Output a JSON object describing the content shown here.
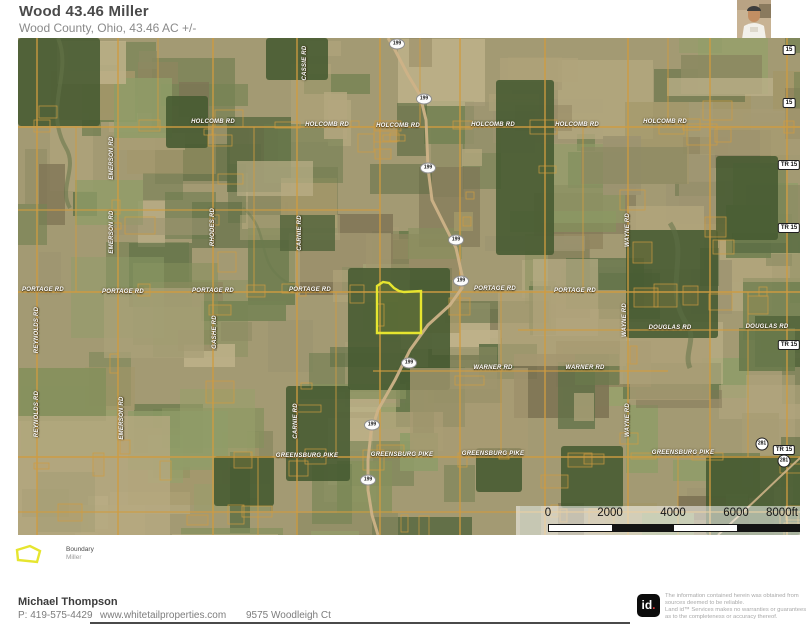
{
  "header": {
    "title": "Wood 43.46 Miller",
    "subtitle": "Wood County, Ohio, 43.46 AC +/-"
  },
  "map": {
    "road_labels": [
      {
        "text": "HOLCOMB RD",
        "x": 195,
        "y": 84,
        "vertical": false
      },
      {
        "text": "HOLCOMB RD",
        "x": 309,
        "y": 87,
        "vertical": false
      },
      {
        "text": "HOLCOMB RD",
        "x": 380,
        "y": 88,
        "vertical": false
      },
      {
        "text": "HOLCOMB RD",
        "x": 475,
        "y": 87,
        "vertical": false
      },
      {
        "text": "HOLCOMB RD",
        "x": 559,
        "y": 87,
        "vertical": false
      },
      {
        "text": "HOLCOMB RD",
        "x": 647,
        "y": 84,
        "vertical": false
      },
      {
        "text": "PORTAGE RD",
        "x": 25,
        "y": 252,
        "vertical": false
      },
      {
        "text": "PORTAGE RD",
        "x": 105,
        "y": 254,
        "vertical": false
      },
      {
        "text": "PORTAGE RD",
        "x": 195,
        "y": 253,
        "vertical": false
      },
      {
        "text": "PORTAGE RD",
        "x": 292,
        "y": 252,
        "vertical": false
      },
      {
        "text": "PORTAGE RD",
        "x": 477,
        "y": 251,
        "vertical": false
      },
      {
        "text": "PORTAGE RD",
        "x": 557,
        "y": 253,
        "vertical": false
      },
      {
        "text": "DOUGLAS RD",
        "x": 652,
        "y": 290,
        "vertical": false
      },
      {
        "text": "DOUGLAS RD",
        "x": 749,
        "y": 289,
        "vertical": false
      },
      {
        "text": "WARNER RD",
        "x": 475,
        "y": 330,
        "vertical": false
      },
      {
        "text": "WARNER RD",
        "x": 567,
        "y": 330,
        "vertical": false
      },
      {
        "text": "GREENSBURG PIKE",
        "x": 289,
        "y": 418,
        "vertical": false
      },
      {
        "text": "GREENSBURG PIKE",
        "x": 384,
        "y": 417,
        "vertical": false
      },
      {
        "text": "GREENSBURG PIKE",
        "x": 475,
        "y": 416,
        "vertical": false
      },
      {
        "text": "GREENSBURG PIKE",
        "x": 665,
        "y": 415,
        "vertical": false
      },
      {
        "text": "REYNOLDS RD",
        "x": 19,
        "y": 292,
        "vertical": true
      },
      {
        "text": "REYNOLDS RD",
        "x": 19,
        "y": 376,
        "vertical": true
      },
      {
        "text": "EMERSON RD",
        "x": 94,
        "y": 120,
        "vertical": true
      },
      {
        "text": "EMERSON RD",
        "x": 94,
        "y": 194,
        "vertical": true
      },
      {
        "text": "EMERSON RD",
        "x": 104,
        "y": 380,
        "vertical": true
      },
      {
        "text": "RHODES RD",
        "x": 195,
        "y": 189,
        "vertical": true
      },
      {
        "text": "CARNIE RD",
        "x": 282,
        "y": 195,
        "vertical": true
      },
      {
        "text": "CARNIE RD",
        "x": 278,
        "y": 383,
        "vertical": true
      },
      {
        "text": "GASHE RD",
        "x": 197,
        "y": 294,
        "vertical": true
      },
      {
        "text": "CASSIE RD",
        "x": 287,
        "y": 25,
        "vertical": true
      },
      {
        "text": "WAYNE RD",
        "x": 610,
        "y": 192,
        "vertical": true
      },
      {
        "text": "WAYNE RD",
        "x": 607,
        "y": 282,
        "vertical": true
      },
      {
        "text": "WAYNE RD",
        "x": 610,
        "y": 382,
        "vertical": true
      }
    ],
    "route_shields": [
      {
        "text": "199",
        "x": 379,
        "y": 6
      },
      {
        "text": "199",
        "x": 406,
        "y": 61
      },
      {
        "text": "199",
        "x": 410,
        "y": 130
      },
      {
        "text": "199",
        "x": 438,
        "y": 202
      },
      {
        "text": "199",
        "x": 443,
        "y": 243
      },
      {
        "text": "199",
        "x": 391,
        "y": 325
      },
      {
        "text": "199",
        "x": 354,
        "y": 387
      },
      {
        "text": "199",
        "x": 350,
        "y": 442
      }
    ],
    "edge_badges": [
      {
        "text": "15",
        "x": 771,
        "y": 12,
        "shape": "rect"
      },
      {
        "text": "15",
        "x": 771,
        "y": 65,
        "shape": "rect"
      },
      {
        "text": "TR 15",
        "x": 771,
        "y": 127,
        "shape": "rect"
      },
      {
        "text": "TR 15",
        "x": 771,
        "y": 190,
        "shape": "rect"
      },
      {
        "text": "TR 15",
        "x": 771,
        "y": 307,
        "shape": "rect"
      },
      {
        "text": "TR 15",
        "x": 766,
        "y": 412,
        "shape": "rect"
      },
      {
        "text": "281",
        "x": 744,
        "y": 406,
        "shape": "circle"
      },
      {
        "text": "281",
        "x": 766,
        "y": 423,
        "shape": "circle"
      }
    ],
    "scale_bar": {
      "ticks": [
        {
          "label": "0",
          "x": 32
        },
        {
          "label": "2000",
          "x": 94
        },
        {
          "label": "4000",
          "x": 157
        },
        {
          "label": "6000",
          "x": 220
        },
        {
          "label": "8000ft",
          "x": 266
        }
      ]
    }
  },
  "legend": {
    "label": "Boundary",
    "sublabel": "Miller"
  },
  "footer": {
    "agent": "Michael Thompson",
    "phone": "P: 419-575-4429",
    "website": "www.whitetailproperties.com",
    "address": "9575 Woodleigh Ct",
    "logo": "id",
    "logo_dot": ".",
    "disclaimer_lines": [
      "The information contained herein was obtained from",
      "sources deemed to be reliable.",
      "Land id™ Services makes no warranties or guarantees",
      "as to the completeness or accuracy thereof."
    ]
  },
  "colors": {
    "boundary": "#e6e52f",
    "parcel": "#d09c40",
    "road": "#cdb287",
    "accent_red": "#e03a3a"
  }
}
